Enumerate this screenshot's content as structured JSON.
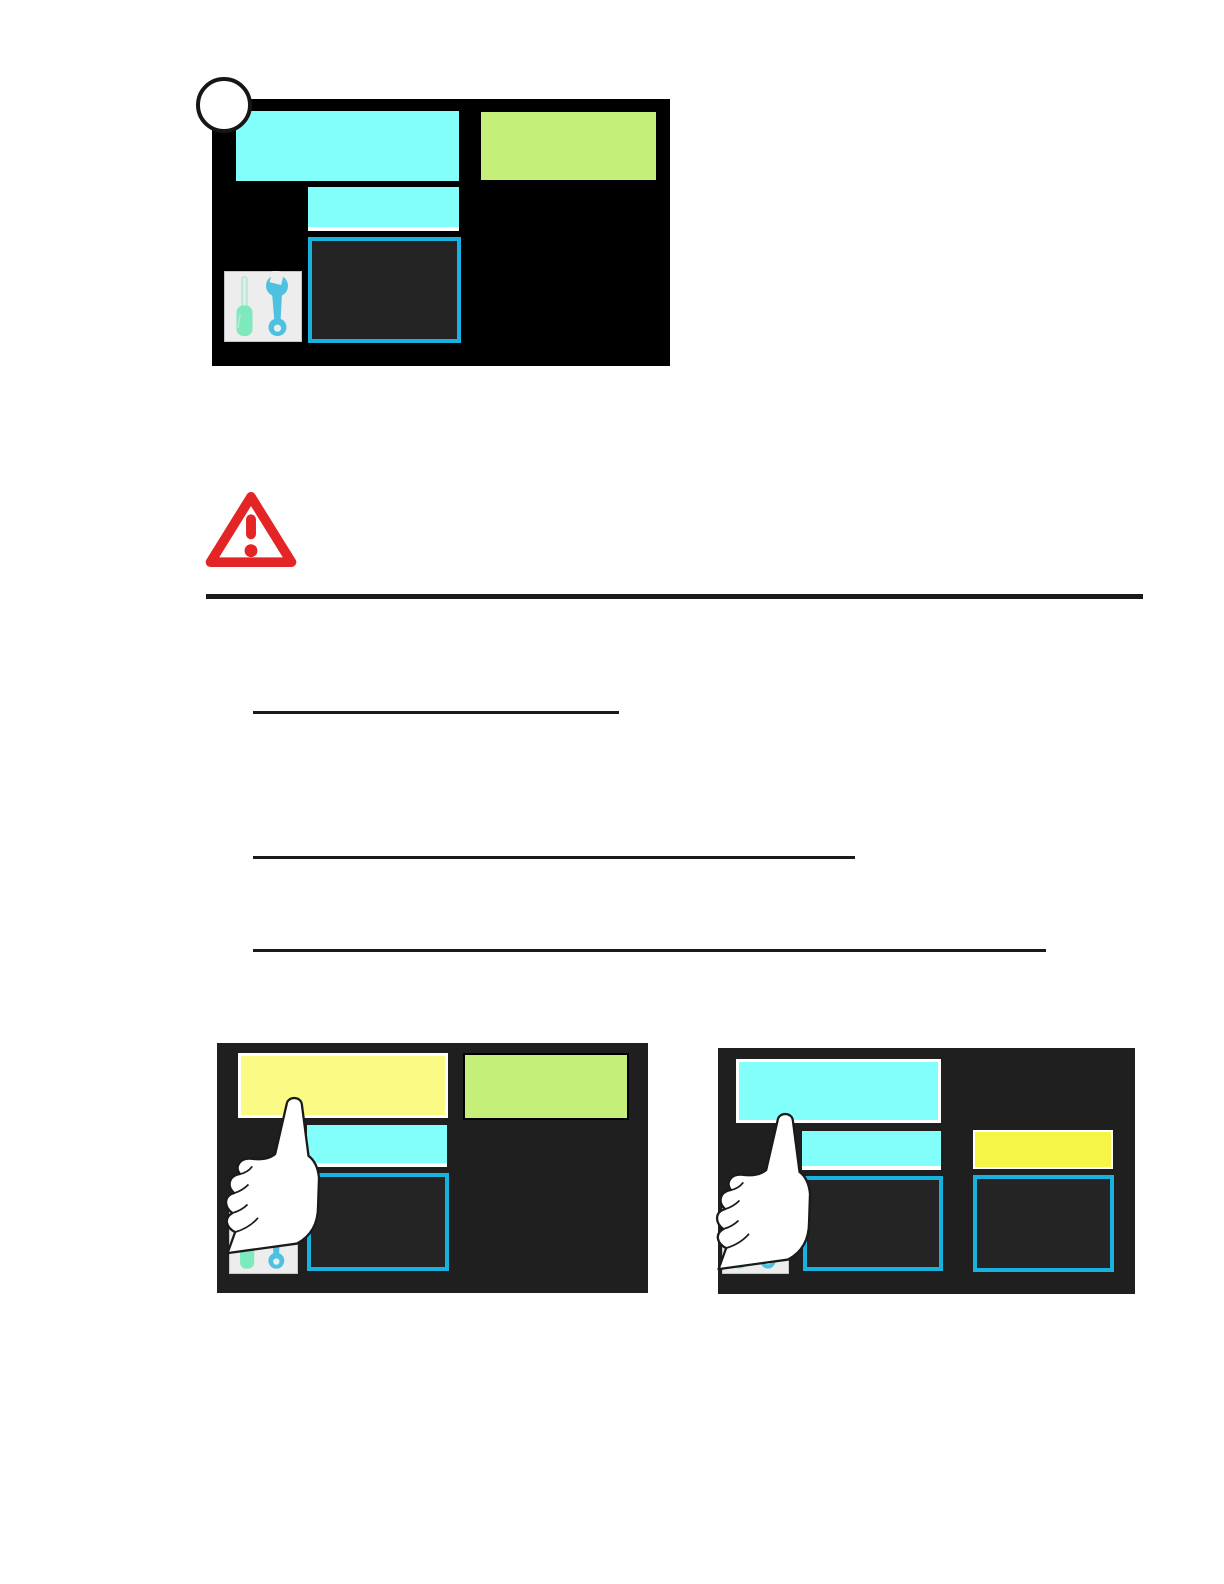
{
  "page": {
    "width": 1224,
    "height": 1584,
    "background": "#FFFFFF"
  },
  "step_marker": {
    "label": ""
  },
  "colors": {
    "cyan": "#82FFFB",
    "green": "#C4EF78",
    "yellow-pale": "#FAFA85",
    "yellow-bright": "#F5F546",
    "outline-cyan": "#18B2DE",
    "panel-black": "#000000",
    "panel-dark": "#1F1F1F",
    "box-fill": "#242424",
    "warning-red": "#E32526",
    "ink": "#1A1A1A",
    "tools-bg": "#EDEDED",
    "mint": "#7DE9BD",
    "wrench-blue": "#4EC1E0",
    "white": "#FFFFFF"
  },
  "icons": {
    "tools": "tools-icon (screwdriver and wrench)",
    "hand": "pointing-hand-icon",
    "warning": "warning-triangle-icon",
    "marker": "step-circle-marker"
  },
  "figures": [
    {
      "id": "fig-menu-home",
      "x": 212,
      "y": 99,
      "w": 458,
      "h": 267,
      "bg": "panel-black",
      "tiles": [
        {
          "name": "menu-tile-large-cyan",
          "x": 24,
          "y": 12,
          "w": 223,
          "h": 70,
          "fill": "cyan"
        },
        {
          "name": "menu-tile-green",
          "x": 269,
          "y": 13,
          "w": 175,
          "h": 68,
          "fill": "green"
        },
        {
          "name": "menu-tile-small-cyan",
          "x": 96,
          "y": 88,
          "w": 151,
          "h": 44,
          "fill": "cyan",
          "white_bottom": true
        },
        {
          "name": "menu-box-outlined",
          "x": 96,
          "y": 138,
          "w": 153,
          "h": 106,
          "fill": "box-fill",
          "outline": true
        }
      ]
    },
    {
      "id": "fig-touch-left",
      "x": 217,
      "y": 1043,
      "w": 431,
      "h": 250,
      "bg": "panel-dark",
      "tiles": [
        {
          "name": "menu-tile-large-yellow",
          "x": 21,
          "y": 10,
          "w": 210,
          "h": 65,
          "fill": "yellow-pale",
          "white_border": true
        },
        {
          "name": "menu-tile-green",
          "x": 246,
          "y": 10,
          "w": 166,
          "h": 67,
          "fill": "green",
          "black_border": true
        },
        {
          "name": "menu-tile-small-cyan",
          "x": 90,
          "y": 82,
          "w": 140,
          "h": 42,
          "fill": "cyan",
          "white_bottom": true
        },
        {
          "name": "menu-box-outlined",
          "x": 90,
          "y": 130,
          "w": 142,
          "h": 98,
          "fill": "box-fill",
          "outline": true
        }
      ]
    },
    {
      "id": "fig-touch-right",
      "x": 718,
      "y": 1048,
      "w": 417,
      "h": 246,
      "bg": "panel-dark",
      "tiles": [
        {
          "name": "menu-tile-large-cyan",
          "x": 18,
          "y": 11,
          "w": 205,
          "h": 64,
          "fill": "cyan",
          "white_border": true
        },
        {
          "name": "menu-tile-small-cyan",
          "x": 84,
          "y": 83,
          "w": 139,
          "h": 39,
          "fill": "cyan",
          "white_bottom": true
        },
        {
          "name": "menu-tile-yellow",
          "x": 255,
          "y": 82,
          "w": 140,
          "h": 39,
          "fill": "yellow-bright",
          "white_border2": true
        },
        {
          "name": "menu-box-outlined-left",
          "x": 85,
          "y": 128,
          "w": 140,
          "h": 95,
          "fill": "box-fill",
          "outline": true
        },
        {
          "name": "menu-box-outlined-right",
          "x": 255,
          "y": 127,
          "w": 141,
          "h": 97,
          "fill": "box-fill",
          "outline": true
        }
      ]
    }
  ],
  "rules": [
    {
      "name": "section-divider",
      "x": 206,
      "y": 594,
      "w": 937,
      "h": 5,
      "color": "ink",
      "interactable": false
    },
    {
      "name": "link-underline-1",
      "x": 253,
      "y": 711,
      "w": 366,
      "h": 3,
      "color": "ink",
      "interactable": true
    },
    {
      "name": "link-underline-2",
      "x": 253,
      "y": 856,
      "w": 602,
      "h": 3,
      "color": "ink",
      "interactable": true
    },
    {
      "name": "link-underline-3",
      "x": 253,
      "y": 949,
      "w": 793,
      "h": 3,
      "color": "ink",
      "interactable": true
    }
  ]
}
